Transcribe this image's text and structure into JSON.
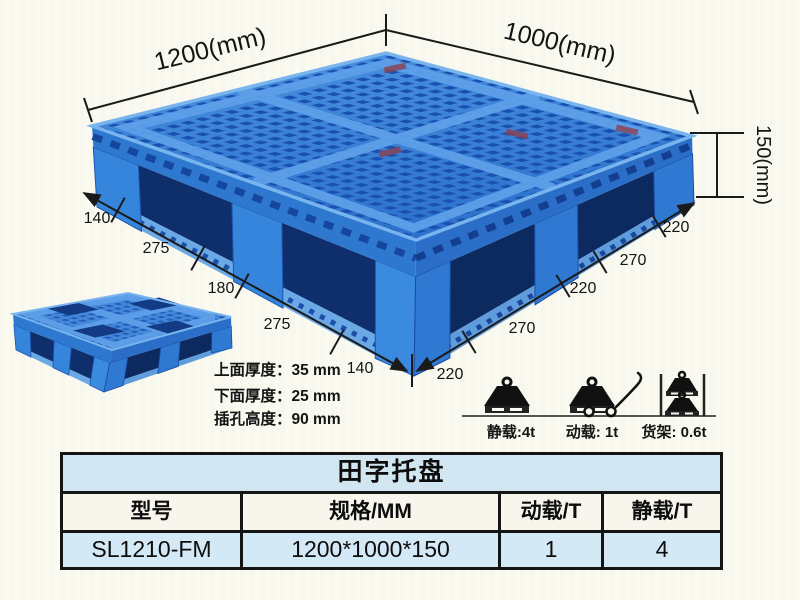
{
  "diagram": {
    "width_label": "1200(mm)",
    "depth_label": "1000(mm)",
    "height_label": "150(mm)",
    "bottom_left_segments": [
      "140",
      "275",
      "180",
      "275",
      "140"
    ],
    "bottom_right_segments": [
      "220",
      "270",
      "220",
      "270",
      "220"
    ],
    "thickness_notes": [
      "上面厚度：35 mm",
      "下面厚度：25 mm",
      "插孔高度：90 mm"
    ],
    "load_ratings": [
      {
        "icon": "static-load-icon",
        "label": "静载:4t"
      },
      {
        "icon": "dynamic-load-icon",
        "label": "动载: 1t"
      },
      {
        "icon": "rack-load-icon",
        "label": "货架: 0.6t"
      }
    ],
    "colors": {
      "pallet_blue": "#3b86dc",
      "pallet_dark_blue": "#1c55b4",
      "pallet_light_blue": "#5ea0e8",
      "pocket_shadow": "#0e2f6b",
      "dimension_line": "#1a1a1a"
    }
  },
  "spec_table": {
    "title": "田字托盘",
    "headers": [
      "型号",
      "规格/MM",
      "动载/T",
      "静载/T"
    ],
    "rows": [
      [
        "SL1210-FM",
        "1200*1000*150",
        "1",
        "4"
      ]
    ],
    "title_bg": "#d2e6f1",
    "header_bg": "#f8f6ec",
    "row_bg": "#d3e9f5"
  }
}
